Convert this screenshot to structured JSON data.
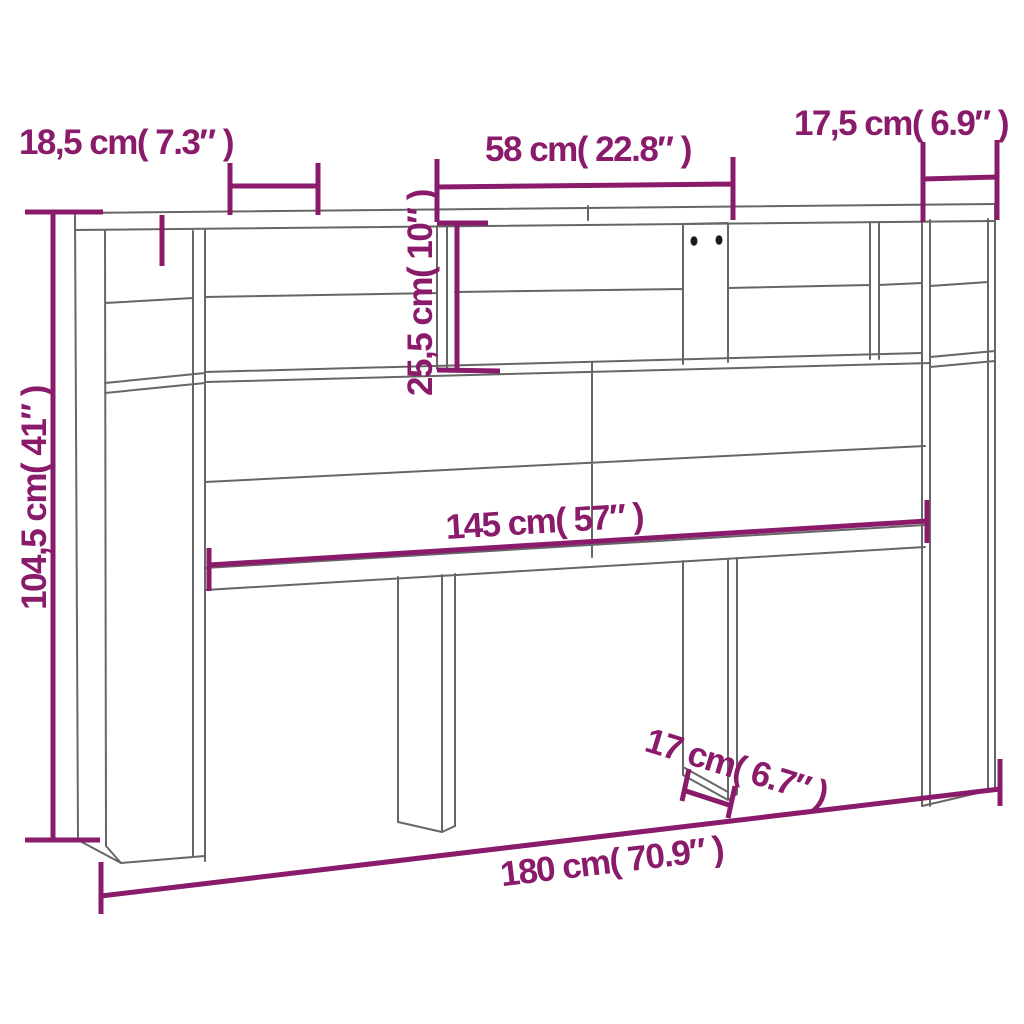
{
  "diagram": {
    "type": "furniture-dimension-diagram",
    "subject": "headboard cabinet with storage shelves, line drawing with dimension callouts",
    "colors": {
      "dimension": "#8a1b6b",
      "outline": "#666666",
      "screw_holes": "#1a1a1a",
      "background": "#ffffff"
    },
    "dimensions": {
      "top_left_depth": {
        "label": "18,5 cm( 7.3″ )"
      },
      "top_center_width": {
        "label": "58 cm( 22.8″ )"
      },
      "top_right_depth": {
        "label": "17,5 cm( 6.9″ )"
      },
      "shelf_height": {
        "label": "25,5 cm( 10″ )"
      },
      "overall_height": {
        "label": "104,5 cm( 41″ )"
      },
      "inner_width": {
        "label": "145 cm( 57″ )"
      },
      "leg_depth": {
        "label": "17 cm( 6.7″ )"
      },
      "overall_width": {
        "label": "180 cm( 70.9″ )"
      }
    }
  }
}
